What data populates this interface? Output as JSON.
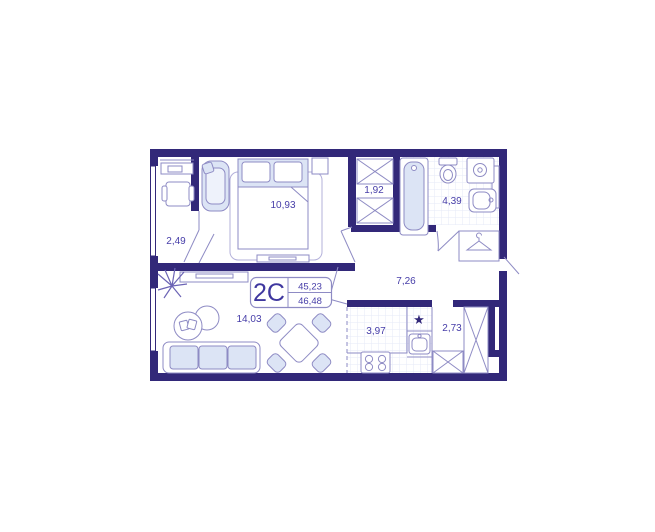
{
  "floorplan": {
    "unit": {
      "type": "2C",
      "value_top": "45,23",
      "value_bottom": "46,48"
    },
    "rooms": {
      "loggia": "2,49",
      "bedroom": "10,93",
      "closet": "1,92",
      "bathroom": "4,39",
      "hallway": "7,26",
      "living": "14,03",
      "kitchen": "3,97",
      "wardrobe": "2,73"
    },
    "symbols": {
      "kitchen_star": "★"
    },
    "colors": {
      "wall": "#322879",
      "furniture_line": "#8e8bc4",
      "light_fill": "#dce4f5",
      "label_text": "#463da8",
      "tile_grid": "#e6eaf7",
      "background": "#ffffff"
    }
  }
}
